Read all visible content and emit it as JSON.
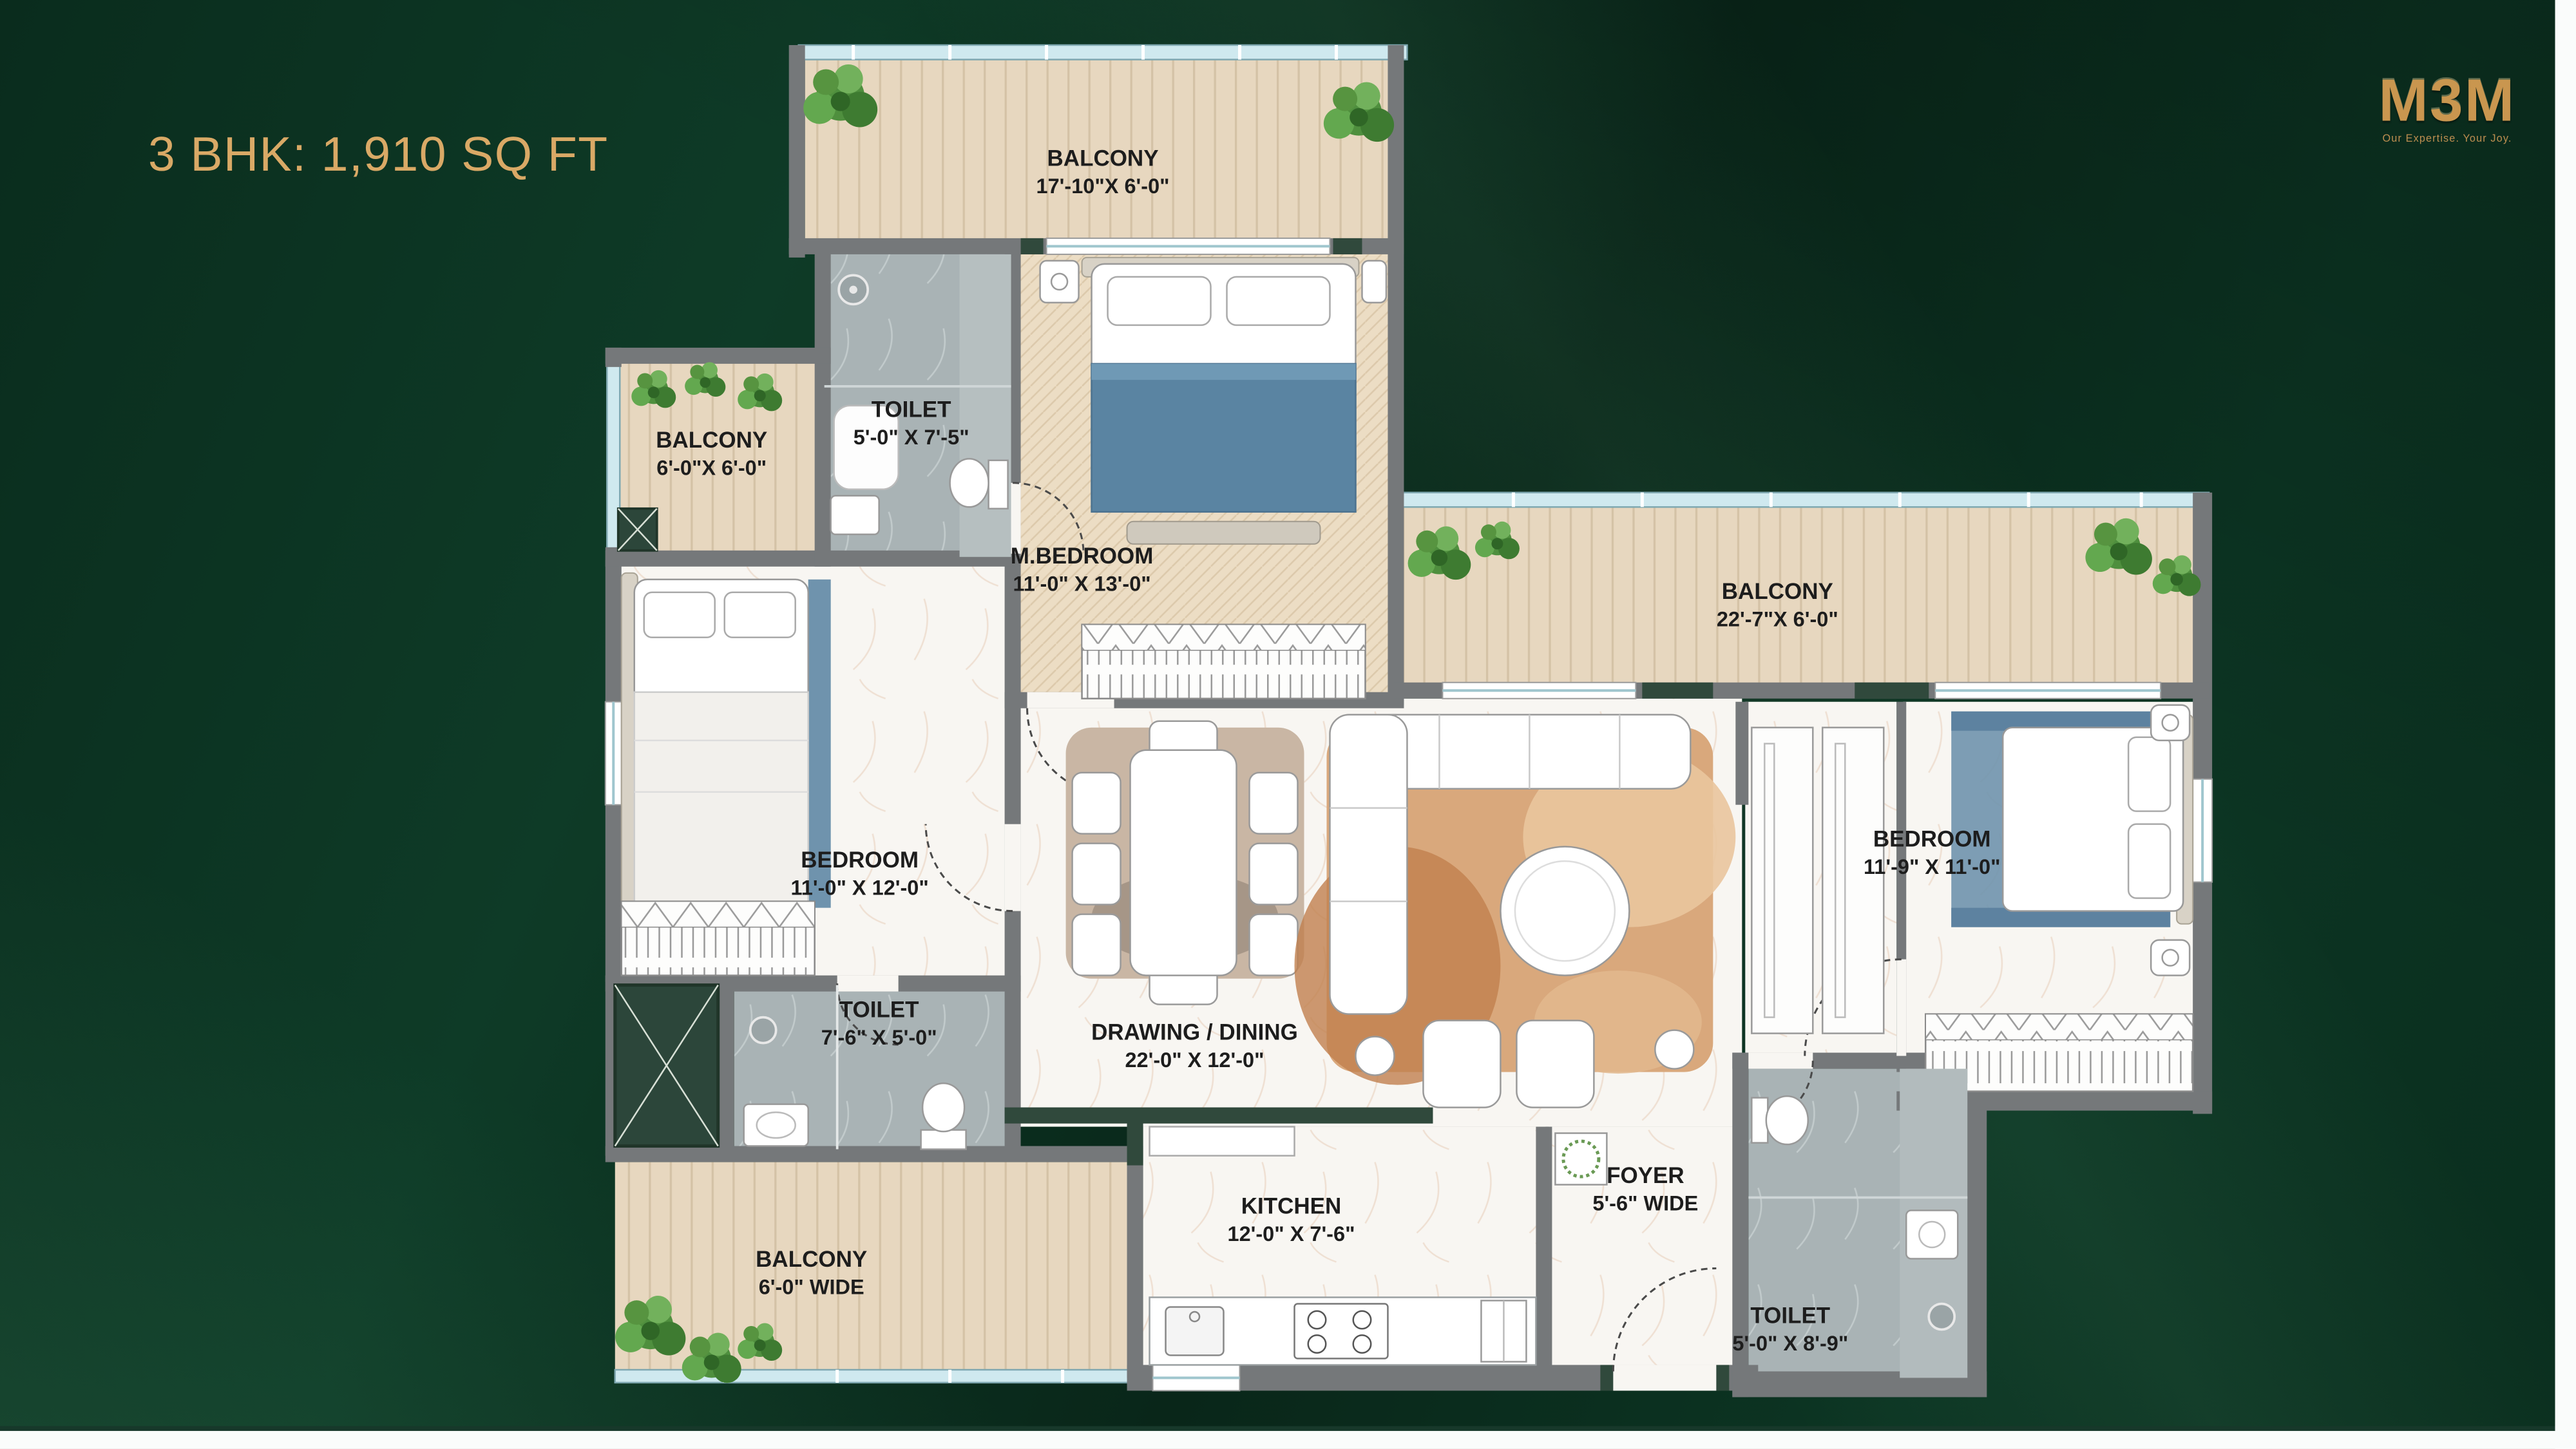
{
  "title": "3 BHK: 1,910 SQ FT",
  "logo": {
    "name": "M3M",
    "tagline": "Our Expertise. Your Joy."
  },
  "colors": {
    "background_green": "#0c3322",
    "accent_gold": "#d9a966",
    "wood_floor": "#e7d7bf",
    "herringbone_floor": "#ecddc4",
    "marble_floor": "#f8f6f2",
    "toilet_floor": "#a9b3b5",
    "wall_grey": "#75787a",
    "wall_green": "#30493c",
    "glass_blue": "#cfe9ef",
    "rug_terracotta": "#d9a87c",
    "bed_blue": "#5a84a2",
    "plant_green": "#4f8f3e",
    "label_text": "#1d1d1d"
  },
  "rooms": [
    {
      "id": "balcony-top",
      "name": "BALCONY",
      "dim": "17'-10\"X 6'-0\""
    },
    {
      "id": "toilet-master",
      "name": "TOILET",
      "dim": "5'-0\" X 7'-5\""
    },
    {
      "id": "master-bedroom",
      "name": "M.BEDROOM",
      "dim": "11'-0\" X 13'-0\""
    },
    {
      "id": "balcony-left",
      "name": "BALCONY",
      "dim": "6'-0\"X 6'-0\""
    },
    {
      "id": "balcony-right",
      "name": "BALCONY",
      "dim": "22'-7\"X 6'-0\""
    },
    {
      "id": "bedroom-left",
      "name": "BEDROOM",
      "dim": "11'-0\" X 12'-0\""
    },
    {
      "id": "bedroom-right",
      "name": "BEDROOM",
      "dim": "11'-9\" X 11'-0\""
    },
    {
      "id": "toilet-left",
      "name": "TOILET",
      "dim": "7'-6\" X 5'-0\""
    },
    {
      "id": "drawing-dining",
      "name": "DRAWING / DINING",
      "dim": "22'-0\" X 12'-0\""
    },
    {
      "id": "kitchen",
      "name": "KITCHEN",
      "dim": "12'-0\" X 7'-6\""
    },
    {
      "id": "foyer",
      "name": "FOYER",
      "dim": "5'-6\" WIDE"
    },
    {
      "id": "balcony-bottom",
      "name": "BALCONY",
      "dim": "6'-0\" WIDE"
    },
    {
      "id": "toilet-entry",
      "name": "TOILET",
      "dim": "5'-0\" X 8'-9\""
    }
  ]
}
